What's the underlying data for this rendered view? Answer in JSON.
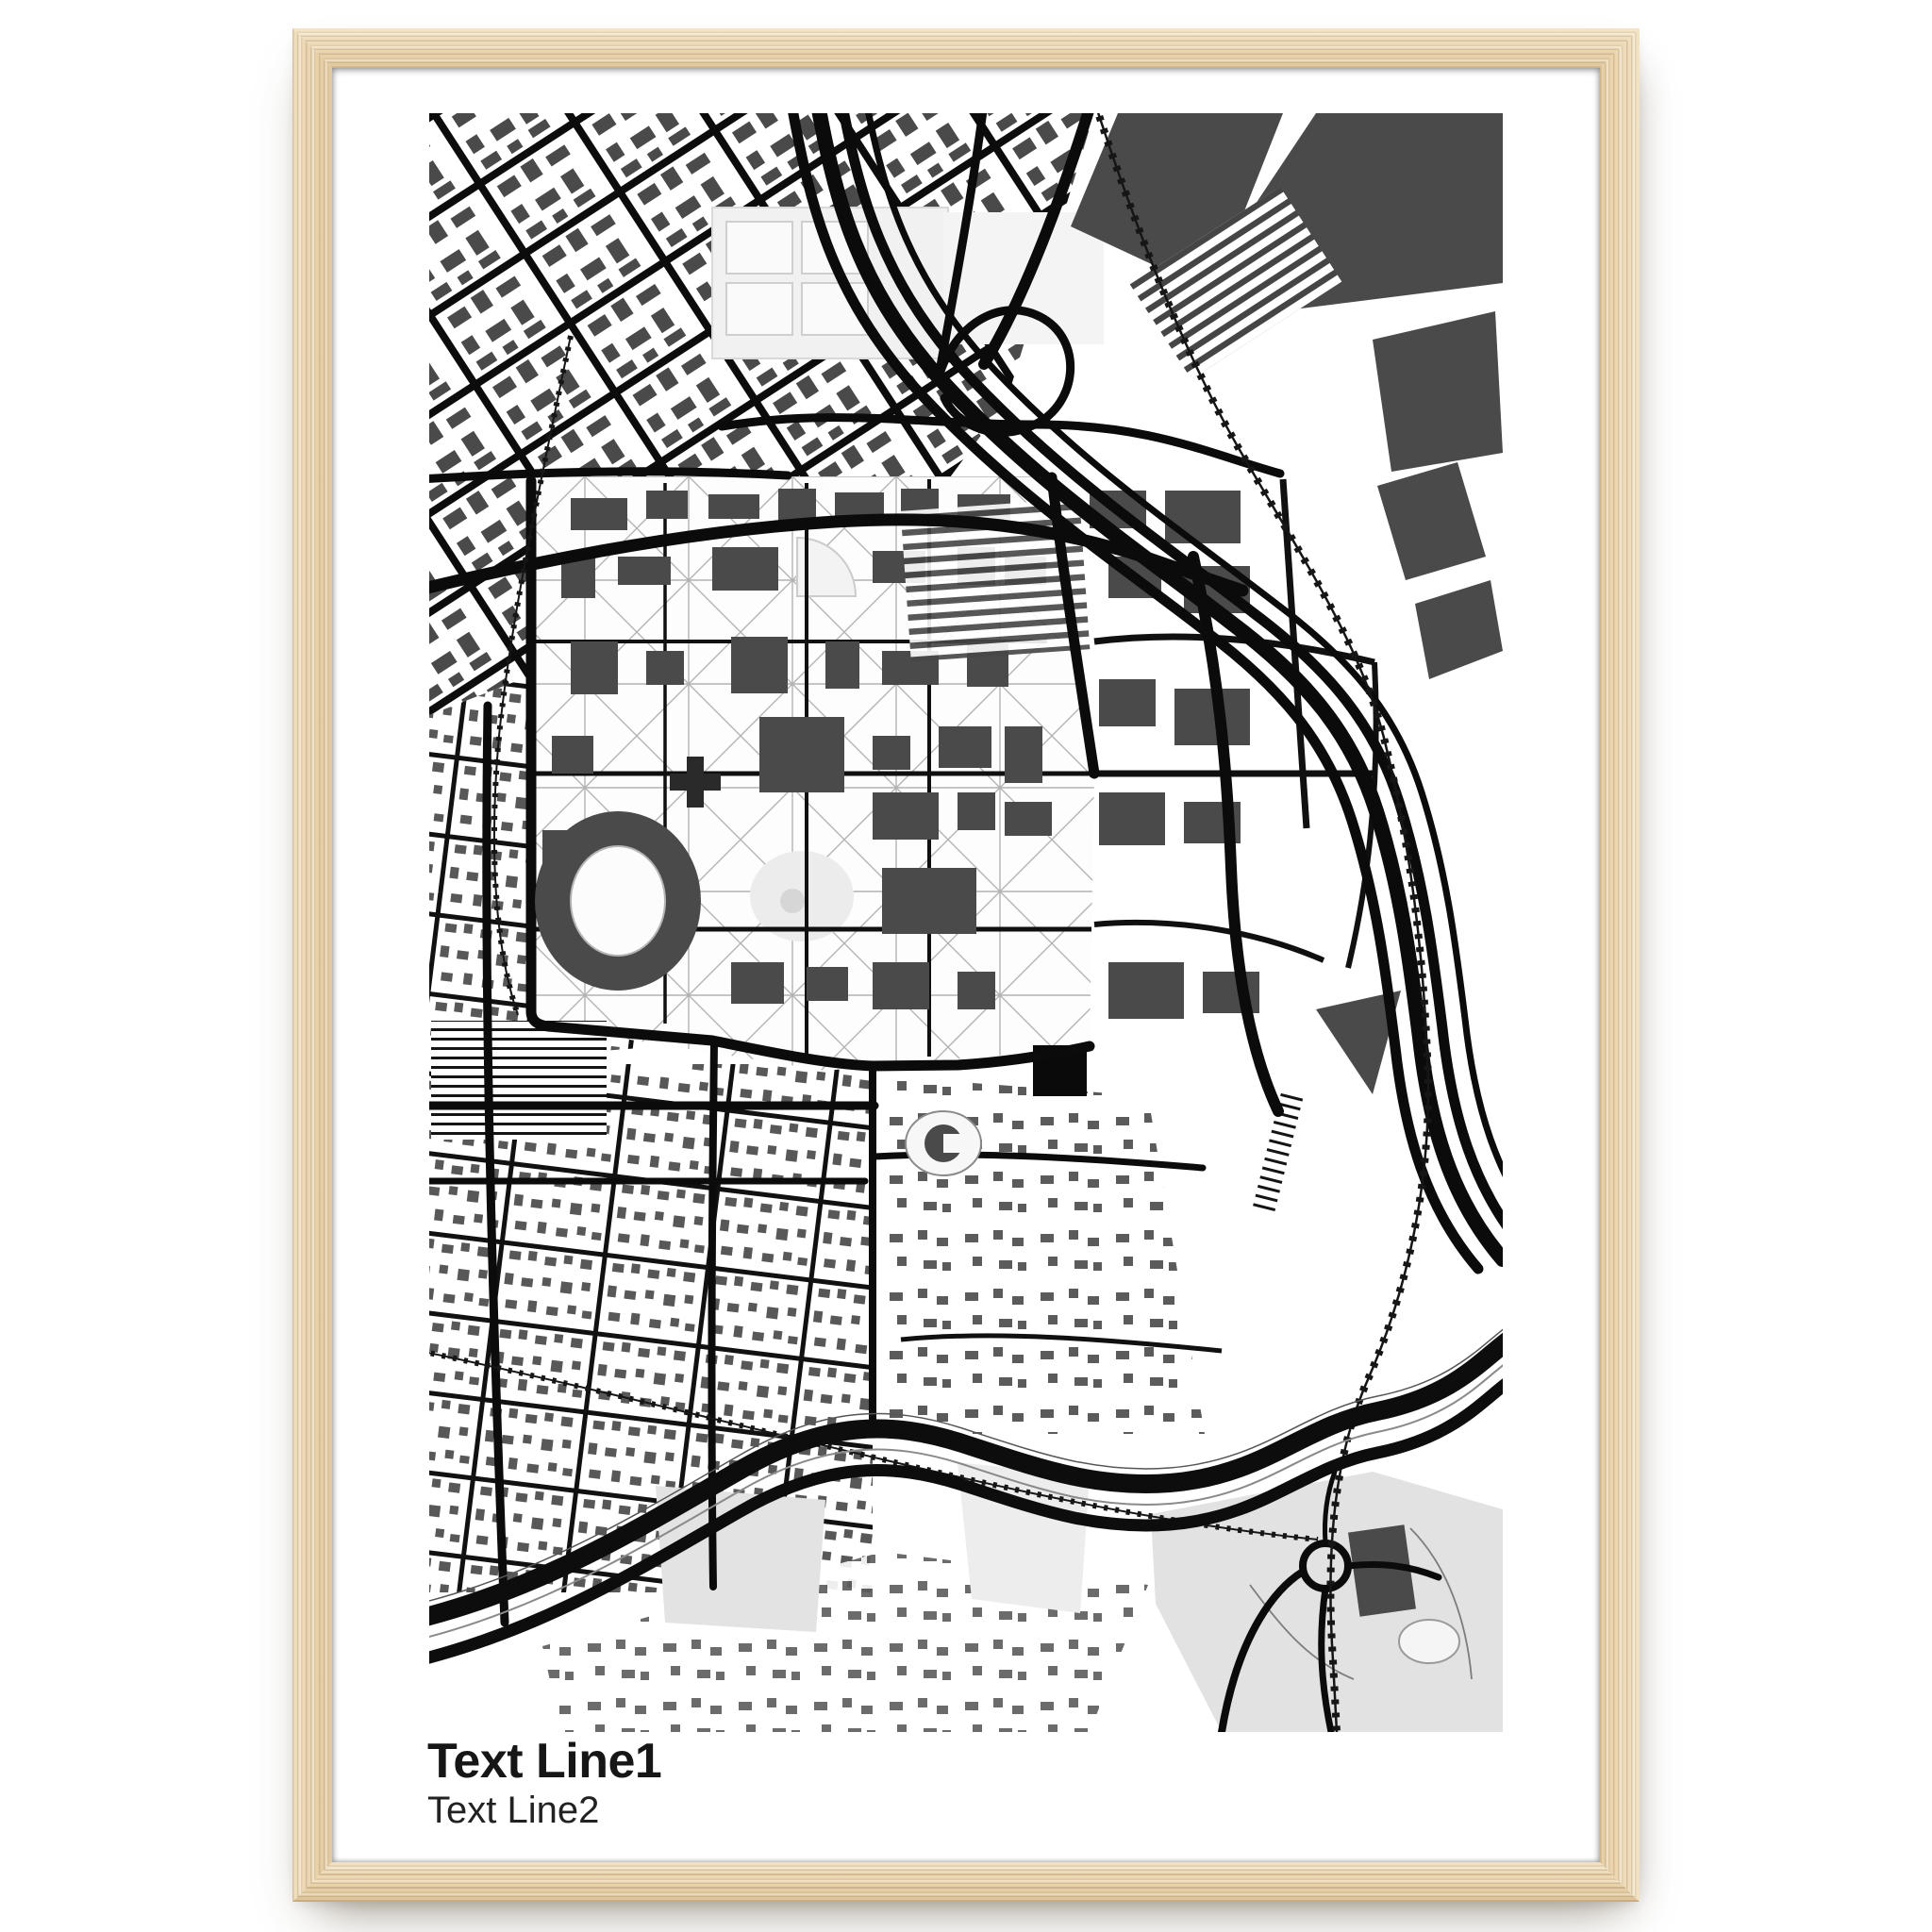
{
  "poster": {
    "title_line1": "Text Line1",
    "title_line2": "Text Line2",
    "artwork_description": "black and white city street map art print"
  },
  "mockup": {
    "frame_style": "natural light wood frame",
    "mat_color_name": "white"
  },
  "colors": {
    "wood": "#ead6b1",
    "paper": "#ffffff",
    "map_ink": "#0b0b0b",
    "building_gray": "#4a4a4a",
    "park_gray": "#e2e2e2",
    "text": "#161616"
  }
}
